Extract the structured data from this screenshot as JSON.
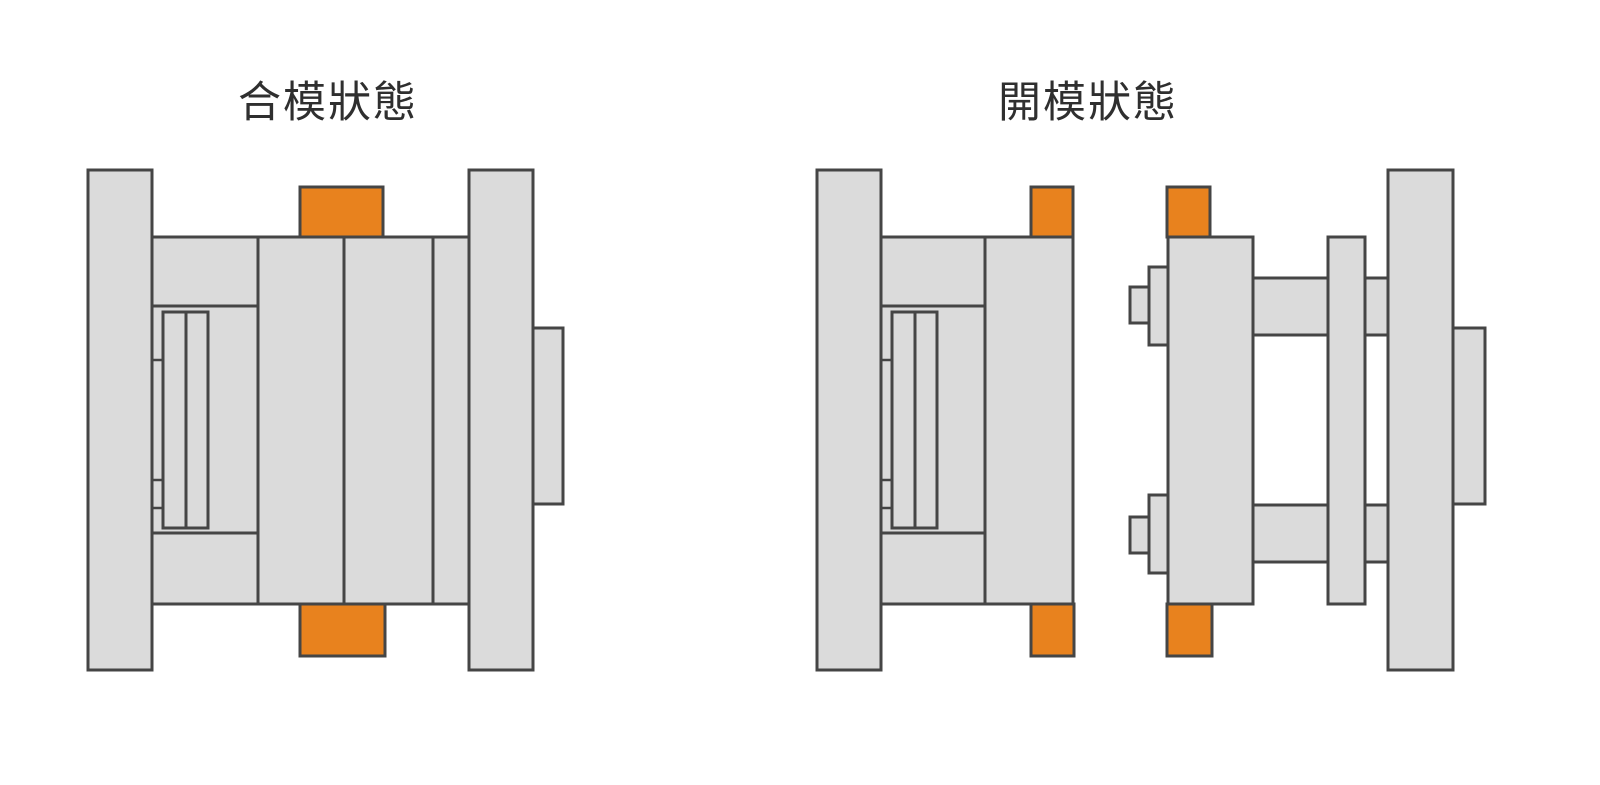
{
  "page": {
    "width": 1600,
    "height": 785,
    "background": "#ffffff"
  },
  "palette": {
    "gray": "#dbdbdb",
    "orange": "#e8821e",
    "outline": "#454545",
    "title_color": "#2f2f2f"
  },
  "titles": {
    "closed": "合模狀態",
    "open": "開模狀態"
  },
  "diagrams": [
    {
      "id": "mold-closed-diagram",
      "title": "合模狀態",
      "parts": [
        {
          "name": "movable-clamp-plate",
          "x": 88,
          "y": 170,
          "w": 64,
          "h": 500,
          "fill": "gray"
        },
        {
          "name": "ejector-housing",
          "x": 152,
          "y": 237,
          "w": 106,
          "h": 367,
          "fill": "gray"
        },
        {
          "name": "ejector-cavity",
          "x": 152,
          "y": 306,
          "w": 106,
          "h": 227,
          "fill": "gray"
        },
        {
          "name": "ejector-base-plate",
          "x": 163,
          "y": 312,
          "w": 23,
          "h": 216,
          "fill": "gray"
        },
        {
          "name": "ejector-retainer-plate",
          "x": 186,
          "y": 312,
          "w": 22,
          "h": 216,
          "fill": "gray"
        },
        {
          "name": "core-plate-b",
          "x": 258,
          "y": 237,
          "w": 86,
          "h": 367,
          "fill": "gray"
        },
        {
          "name": "cavity-plate-a",
          "x": 344,
          "y": 237,
          "w": 89,
          "h": 367,
          "fill": "gray"
        },
        {
          "name": "stripper-plate",
          "x": 433,
          "y": 237,
          "w": 36,
          "h": 367,
          "fill": "gray"
        },
        {
          "name": "fixed-clamp-plate",
          "x": 469,
          "y": 170,
          "w": 64,
          "h": 500,
          "fill": "gray"
        },
        {
          "name": "locating-ring",
          "x": 533,
          "y": 328,
          "w": 30,
          "h": 176,
          "fill": "gray"
        },
        {
          "name": "parting-lock-top",
          "x": 300,
          "y": 187,
          "w": 83,
          "h": 50,
          "fill": "orange"
        },
        {
          "name": "parting-lock-bottom",
          "x": 300,
          "y": 604,
          "w": 85,
          "h": 52,
          "fill": "orange"
        }
      ],
      "lines": [
        {
          "name": "stop-pin-line",
          "x1": 152,
          "y1": 360,
          "x2": 163,
          "y2": 360
        },
        {
          "name": "stop-pin-line",
          "x1": 152,
          "y1": 480,
          "x2": 163,
          "y2": 480
        },
        {
          "name": "stop-pin-line",
          "x1": 152,
          "y1": 508,
          "x2": 163,
          "y2": 508
        }
      ]
    },
    {
      "id": "mold-open-diagram",
      "title": "開模狀態",
      "parts": [
        {
          "name": "movable-clamp-plate",
          "x": 817,
          "y": 170,
          "w": 64,
          "h": 500,
          "fill": "gray"
        },
        {
          "name": "ejector-housing",
          "x": 881,
          "y": 237,
          "w": 104,
          "h": 367,
          "fill": "gray"
        },
        {
          "name": "ejector-cavity",
          "x": 881,
          "y": 306,
          "w": 104,
          "h": 227,
          "fill": "gray"
        },
        {
          "name": "ejector-base-plate",
          "x": 892,
          "y": 312,
          "w": 23,
          "h": 216,
          "fill": "gray"
        },
        {
          "name": "ejector-retainer-plate",
          "x": 915,
          "y": 312,
          "w": 22,
          "h": 216,
          "fill": "gray"
        },
        {
          "name": "core-plate-b",
          "x": 985,
          "y": 237,
          "w": 88,
          "h": 367,
          "fill": "gray"
        },
        {
          "name": "parting-lock-top-movable",
          "x": 1031,
          "y": 187,
          "w": 42,
          "h": 50,
          "fill": "orange"
        },
        {
          "name": "parting-lock-bottom-movable",
          "x": 1031,
          "y": 604,
          "w": 43,
          "h": 52,
          "fill": "orange"
        },
        {
          "name": "puller-pin-upper-head",
          "x": 1130,
          "y": 287,
          "w": 19,
          "h": 36,
          "fill": "gray"
        },
        {
          "name": "puller-pin-upper-body",
          "x": 1149,
          "y": 267,
          "w": 19,
          "h": 78,
          "fill": "gray"
        },
        {
          "name": "puller-pin-lower-head",
          "x": 1130,
          "y": 517,
          "w": 19,
          "h": 36,
          "fill": "gray"
        },
        {
          "name": "puller-pin-lower-body",
          "x": 1149,
          "y": 495,
          "w": 19,
          "h": 78,
          "fill": "gray"
        },
        {
          "name": "guide-pin-upper",
          "x": 1253,
          "y": 278,
          "w": 135,
          "h": 57,
          "fill": "gray"
        },
        {
          "name": "guide-pin-lower",
          "x": 1253,
          "y": 505,
          "w": 135,
          "h": 57,
          "fill": "gray"
        },
        {
          "name": "cavity-plate-a",
          "x": 1168,
          "y": 237,
          "w": 85,
          "h": 367,
          "fill": "gray"
        },
        {
          "name": "stripper-plate",
          "x": 1328,
          "y": 237,
          "w": 37,
          "h": 367,
          "fill": "gray"
        },
        {
          "name": "fixed-clamp-plate",
          "x": 1388,
          "y": 170,
          "w": 65,
          "h": 500,
          "fill": "gray"
        },
        {
          "name": "locating-ring",
          "x": 1453,
          "y": 328,
          "w": 32,
          "h": 176,
          "fill": "gray"
        },
        {
          "name": "parting-lock-top-fixed",
          "x": 1167,
          "y": 187,
          "w": 43,
          "h": 50,
          "fill": "orange"
        },
        {
          "name": "parting-lock-bottom-fixed",
          "x": 1167,
          "y": 604,
          "w": 45,
          "h": 52,
          "fill": "orange"
        }
      ],
      "lines": [
        {
          "name": "stop-pin-line",
          "x1": 881,
          "y1": 360,
          "x2": 892,
          "y2": 360
        },
        {
          "name": "stop-pin-line",
          "x1": 881,
          "y1": 480,
          "x2": 892,
          "y2": 480
        },
        {
          "name": "stop-pin-line",
          "x1": 881,
          "y1": 508,
          "x2": 892,
          "y2": 508
        }
      ]
    }
  ]
}
